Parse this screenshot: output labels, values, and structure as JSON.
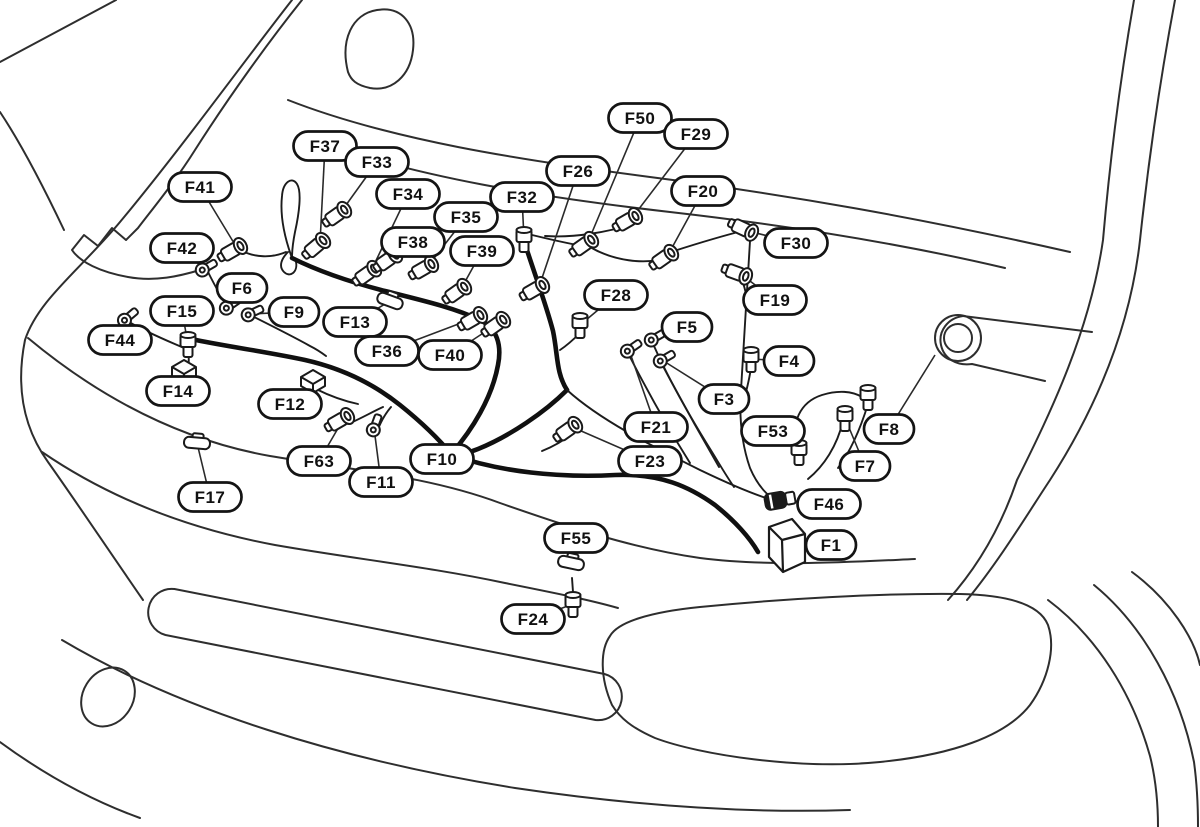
{
  "diagram": {
    "type": "wiring-harness-location-diagram",
    "canvas": {
      "width": 1200,
      "height": 827
    },
    "colors": {
      "background": "#ffffff",
      "body_line": "#2e2e2e",
      "harness_line": "#101010",
      "bubble_fill": "#ffffff",
      "bubble_stroke": "#141414",
      "label_text": "#111111"
    },
    "bubble": {
      "height": 29,
      "corner_radius": 14.5,
      "width_2char": 50,
      "width_3char": 63
    },
    "connectors": [
      {
        "id": "F37",
        "x": 325,
        "y": 146,
        "tx": 320,
        "ty": 243,
        "glyph": "bolt",
        "angle": -40
      },
      {
        "id": "F33",
        "x": 377,
        "y": 162,
        "tx": 341,
        "ty": 212,
        "glyph": "bolt",
        "angle": -35
      },
      {
        "id": "F41",
        "x": 200,
        "y": 187,
        "tx": 237,
        "ty": 248,
        "glyph": "bolt",
        "angle": -30
      },
      {
        "id": "F34",
        "x": 408,
        "y": 194,
        "tx": 371,
        "ty": 271,
        "glyph": "bolt",
        "angle": -35
      },
      {
        "id": "F32",
        "x": 522,
        "y": 197,
        "tx": 524,
        "ty": 239,
        "glyph": "vbolt",
        "angle": 0
      },
      {
        "id": "F35",
        "x": 466,
        "y": 217,
        "tx": 428,
        "ty": 266,
        "glyph": "bolt",
        "angle": -30
      },
      {
        "id": "F38",
        "x": 413,
        "y": 242,
        "tx": 392,
        "ty": 257,
        "glyph": "bolt",
        "angle": -35
      },
      {
        "id": "F39",
        "x": 482,
        "y": 251,
        "tx": 461,
        "ty": 289,
        "glyph": "bolt",
        "angle": -35
      },
      {
        "id": "F42",
        "x": 182,
        "y": 248,
        "tx": 204,
        "ty": 269,
        "glyph": "ring",
        "angle": -30
      },
      {
        "id": "F50",
        "x": 640,
        "y": 118,
        "tx": 588,
        "ty": 242,
        "glyph": "bolt",
        "angle": -35
      },
      {
        "id": "F29",
        "x": 696,
        "y": 134,
        "tx": 632,
        "ty": 218,
        "glyph": "bolt",
        "angle": -30
      },
      {
        "id": "F26",
        "x": 578,
        "y": 171,
        "tx": 539,
        "ty": 287,
        "glyph": "bolt",
        "angle": -30
      },
      {
        "id": "F20",
        "x": 703,
        "y": 191,
        "tx": 668,
        "ty": 255,
        "glyph": "bolt",
        "angle": -35
      },
      {
        "id": "F30",
        "x": 796,
        "y": 243,
        "tx": 748,
        "ty": 231,
        "glyph": "bolt",
        "angle": 25
      },
      {
        "id": "F19",
        "x": 775,
        "y": 300,
        "tx": 742,
        "ty": 275,
        "glyph": "bolt",
        "angle": 20
      },
      {
        "id": "F28",
        "x": 616,
        "y": 295,
        "tx": 580,
        "ty": 325,
        "glyph": "vbolt",
        "angle": 0
      },
      {
        "id": "F6",
        "x": 242,
        "y": 288,
        "tx": 228,
        "ty": 307,
        "glyph": "ring",
        "angle": -35
      },
      {
        "id": "F15",
        "x": 182,
        "y": 311,
        "tx": 188,
        "ty": 344,
        "glyph": "vbolt",
        "angle": 0
      },
      {
        "id": "F9",
        "x": 294,
        "y": 312,
        "tx": 250,
        "ty": 314,
        "glyph": "ring",
        "angle": -25
      },
      {
        "id": "F13",
        "x": 355,
        "y": 322,
        "tx": 390,
        "ty": 301,
        "glyph": "clip",
        "angle": 20
      },
      {
        "id": "F36",
        "x": 387,
        "y": 351,
        "tx": 477,
        "ty": 317,
        "glyph": "bolt",
        "angle": -30
      },
      {
        "id": "F40",
        "x": 450,
        "y": 355,
        "tx": 500,
        "ty": 322,
        "glyph": "bolt",
        "angle": -35
      },
      {
        "id": "F44",
        "x": 120,
        "y": 340,
        "tx": 126,
        "ty": 319,
        "glyph": "ring",
        "angle": -40
      },
      {
        "id": "F14",
        "x": 178,
        "y": 391,
        "tx": 184,
        "ty": 371,
        "glyph": "block",
        "angle": 0
      },
      {
        "id": "F12",
        "x": 290,
        "y": 404,
        "tx": 313,
        "ty": 381,
        "glyph": "block",
        "angle": 0
      },
      {
        "id": "F63",
        "x": 319,
        "y": 461,
        "tx": 344,
        "ty": 418,
        "glyph": "bolt",
        "angle": -30
      },
      {
        "id": "F11",
        "x": 381,
        "y": 482,
        "tx": 374,
        "ty": 428,
        "glyph": "ring",
        "angle": -70
      },
      {
        "id": "F10",
        "x": 442,
        "y": 459,
        "tx": 449,
        "ty": 444,
        "glyph": "none",
        "angle": 0
      },
      {
        "id": "F17",
        "x": 210,
        "y": 497,
        "tx": 197,
        "ty": 443,
        "glyph": "clip",
        "angle": 5
      },
      {
        "id": "F5",
        "x": 687,
        "y": 327,
        "tx": 653,
        "ty": 339,
        "glyph": "ring",
        "angle": -30
      },
      {
        "id": "F21",
        "x": 656,
        "y": 427,
        "tx": 629,
        "ty": 350,
        "glyph": "ring",
        "angle": -35
      },
      {
        "id": "F3",
        "x": 724,
        "y": 399,
        "tx": 662,
        "ty": 360,
        "glyph": "ring",
        "angle": -30
      },
      {
        "id": "F4",
        "x": 789,
        "y": 361,
        "tx": 751,
        "ty": 359,
        "glyph": "vbolt",
        "angle": 0
      },
      {
        "id": "F53",
        "x": 773,
        "y": 431,
        "tx": 799,
        "ty": 452,
        "glyph": "vbolt",
        "angle": 0
      },
      {
        "id": "F23",
        "x": 650,
        "y": 461,
        "tx": 572,
        "ty": 427,
        "glyph": "bolt",
        "angle": -35
      },
      {
        "id": "F7",
        "x": 865,
        "y": 466,
        "tx": 845,
        "ty": 418,
        "glyph": "vbolt",
        "angle": 0
      },
      {
        "id": "F8",
        "x": 889,
        "y": 429,
        "tx": 935,
        "ty": 355,
        "glyph": "none",
        "angle": 0
      },
      {
        "id": "F46",
        "x": 829,
        "y": 504,
        "tx": 780,
        "ty": 500,
        "glyph": "plug",
        "angle": -10
      },
      {
        "id": "F1",
        "x": 831,
        "y": 545,
        "tx": 786,
        "ty": 549,
        "glyph": "box",
        "angle": 0
      },
      {
        "id": "F55",
        "x": 576,
        "y": 538,
        "tx": 571,
        "ty": 563,
        "glyph": "clip",
        "angle": 12
      },
      {
        "id": "F24",
        "x": 533,
        "y": 619,
        "tx": 573,
        "ty": 604,
        "glyph": "vbolt",
        "angle": 0
      }
    ],
    "extra_connectors": [
      {
        "glyph": "vbolt",
        "x": 868,
        "y": 397,
        "angle": 0
      }
    ]
  }
}
